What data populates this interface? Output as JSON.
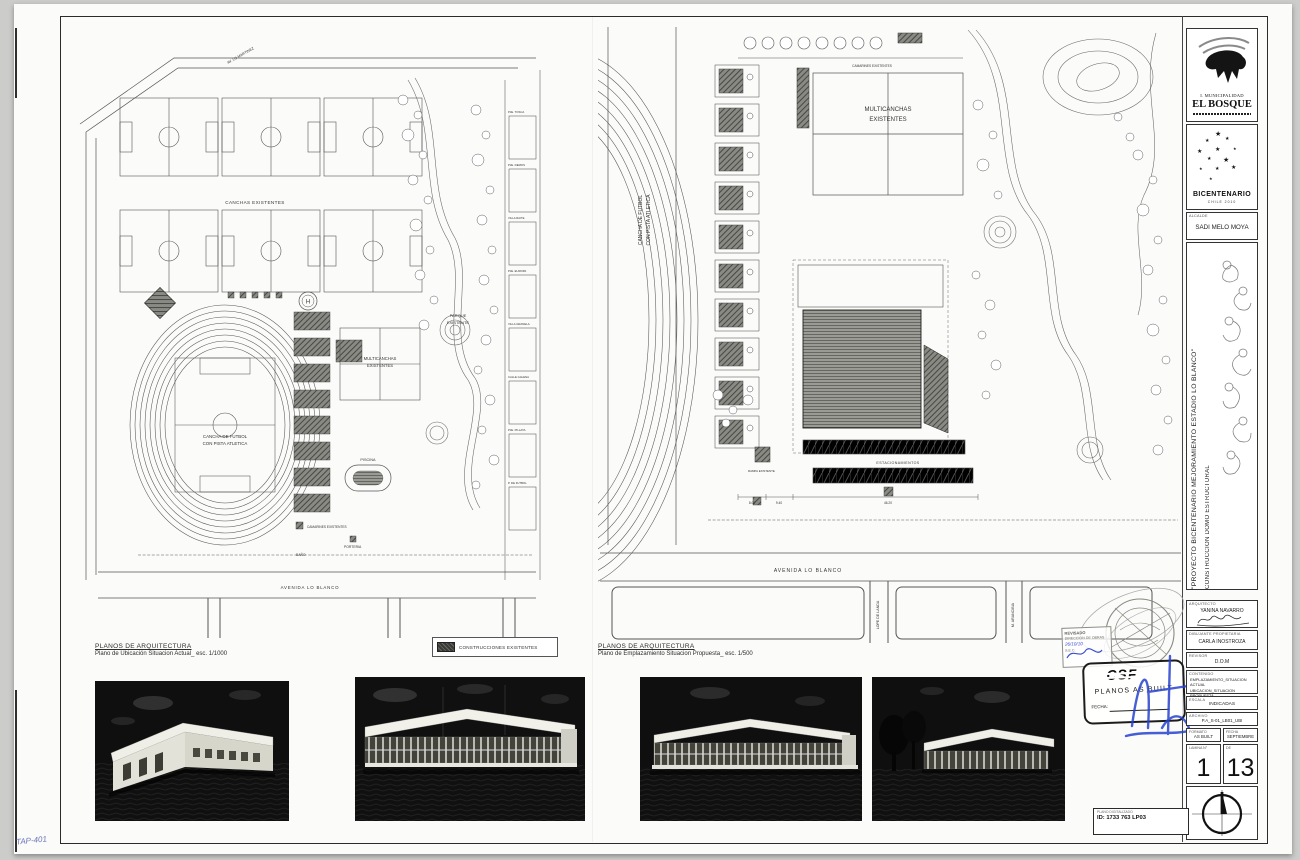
{
  "sheet": {
    "handwriting": "TAP-401"
  },
  "captions": {
    "left_title": "PLANOS DE ARQUITECTURA",
    "left_sub": "Plano de Ubicación Situacion Actual_ esc. 1/1000",
    "right_title": "PLANOS DE ARQUITECTURA",
    "right_sub": "Plano de Emplazamiento Situacion Propuesta_ esc. 1/500",
    "legend": "CONSTRUCCIONES EXISTENTES"
  },
  "left_plan": {
    "av_top": "AV. LO MARTINEZ",
    "canchas": "CANCHAS EXISTENTES",
    "cancha_l1": "CANCHA DE FUTBOL",
    "cancha_l2": "CON PISTA ATLETICA",
    "multi_l1": "MULTICANCHAS",
    "multi_l2": "EXISTENTES",
    "parque_l1": "PARQUE",
    "parque_l2": "EXISTENTE",
    "piscina": "PISCINA",
    "bano": "BAÑO",
    "porteria": "PORTERIA",
    "camarines": "CAMARINES EXISTENTES",
    "avenida": "AVENIDA LO BLANCO",
    "helipad": "H",
    "passages": [
      "PJE. TOSCA",
      "PJE. DEMOS",
      "VILLA RAITE",
      "PJE. EUROPA",
      "VILLA GRANELA",
      "CALLE GALENA",
      "PJE. PILLATA",
      "P. DE FUTBOL"
    ]
  },
  "right_plan": {
    "vert_l1": "CANCHA DE FUTBOL",
    "vert_l2": "CON PISTA ATLETICA",
    "multi_l1": "MULTICANCHAS",
    "multi_l2": "EXISTENTES",
    "camarines": "CAMARINES EXISTENTES",
    "estacionamientos": "ESTACIONAMIENTOS",
    "rampa": "RAMPA EXISTENTE",
    "avenida": "AVENIDA LO BLANCO",
    "lope": "LOPE DE LANDA",
    "arancibia": "M. ARANCIBIA",
    "dim1": "8.00",
    "dim2": "9.40",
    "dim3": "46.20"
  },
  "titleblock": {
    "muni1": "I. MUNICIPALIDAD",
    "muni2": "EL BOSQUE",
    "bicentenario": "BICENTENARIO",
    "bicentenario_sub": "CHILE 2010",
    "alcalde_label": "ALCALDE",
    "alcalde": "SADI MELO MOYA",
    "project1": "\"PROYECTO  BICENTENARIO  MEJORAMIENTO  ESTADIO  LO  BLANCO\"",
    "project2": "CONSTRUCCION DOMO ESTRUCTURAL",
    "fields": [
      {
        "label": "ARQUITECTO",
        "value": "YANINA NAVARRO"
      },
      {
        "label": "DIBUJANTE PROPIETARIA",
        "value": "CARLA INOSTROZA"
      },
      {
        "label": "REVISOR",
        "value": "D.O.M"
      },
      {
        "label": "ESCALA",
        "value": "INDICADAS"
      },
      {
        "label": "ARCHIVO",
        "value": "P.A_S-01_LB01_UBI"
      }
    ],
    "contenido": {
      "label": "CONTENIDO",
      "l1": "EMPLAZAMIENTO_SITUACION ACTUAL",
      "l2": "UBICACION_SITUACION PROPUESTA",
      "l3": "IMAGENES VIRTUALES"
    },
    "formato_label": "FORMATO",
    "formato": "AS BUILT",
    "fecha_label": "FECHA",
    "fecha": "SEPTIEMBRE",
    "lamina_label": "LAMINA N°",
    "lamina": "1",
    "de_label": "DE",
    "de": "13"
  },
  "stamps": {
    "revisado_l1": "REVISADO",
    "revisado_l2": "DIRECCION DE OBRAS",
    "revisado_l3": "26/10/10",
    "revisado_l4": "S.E.C.",
    "csf": "CSF",
    "asbuilt": "PLANOS AS BUILT",
    "asbuilt_fecha": "FECHA:",
    "id_label": "PLANO DIGITALIZADO",
    "id_value": "ID: 1733 763 LP03"
  }
}
